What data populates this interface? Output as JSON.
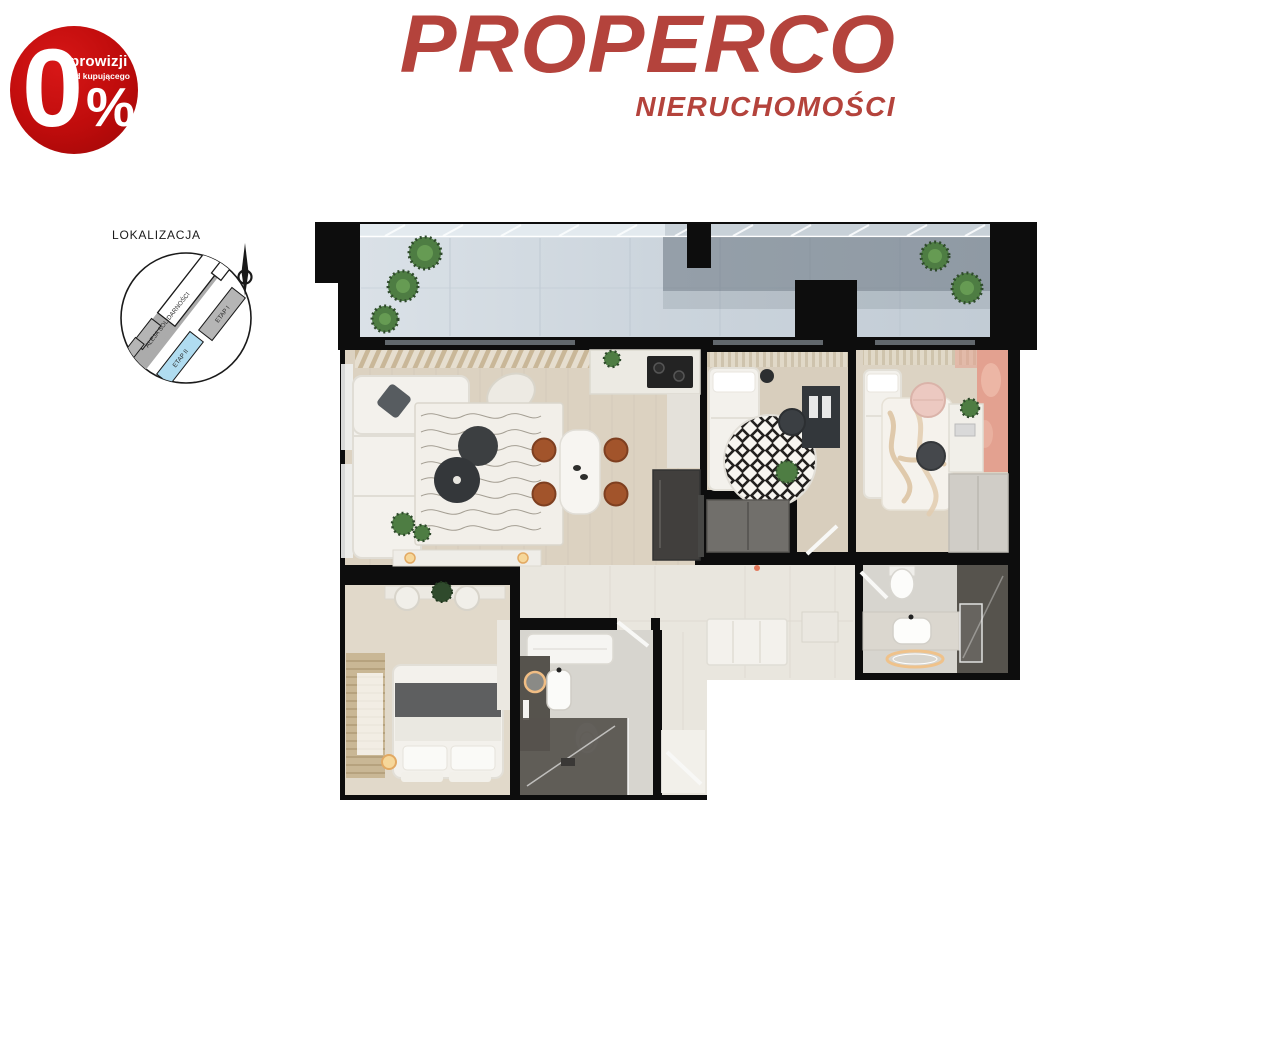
{
  "badge": {
    "value": "0",
    "percent": "%",
    "line1": "prowizji",
    "line2": "od kupującego"
  },
  "logo": {
    "title": "PROPERCO",
    "subtitle": "NIERUCHOMOŚCI"
  },
  "location": {
    "title": "LOKALIZACJA",
    "road": "ALEJA SOLIDARNOŚCI",
    "etap1": "ETAP I",
    "etap2": "ETAP II"
  },
  "palette": {
    "badge": "#c00c0c",
    "logored": "#b4433c",
    "ink": "#1a1a1a",
    "road": "#ababab",
    "bldg": "#b5b5b5",
    "etapblue": "#b0dcf0",
    "wall": "#0d0d0d",
    "balcony": "#cbd4dc",
    "balconyGlass": "#4a5661",
    "woodA": "#dcd2c1",
    "woodB": "#d8cebd",
    "woodC": "#dcd3c3",
    "woodD": "#e1d9ca",
    "tile": "#e9e6de",
    "bath": "#d7d5cf",
    "bathdark": "#56534d",
    "white": "#f3f1ec",
    "dark": "#393c3f",
    "brown": "#a2542b",
    "terracotta": "#e3a190",
    "rug": "#f2efe9",
    "plant": "#4e7d43",
    "plantlight": "#6da258",
    "gray": "#716f6b",
    "cabinet": "#d0cdc7",
    "blanket": "#5e5f60",
    "warm": "#f6d79a"
  }
}
